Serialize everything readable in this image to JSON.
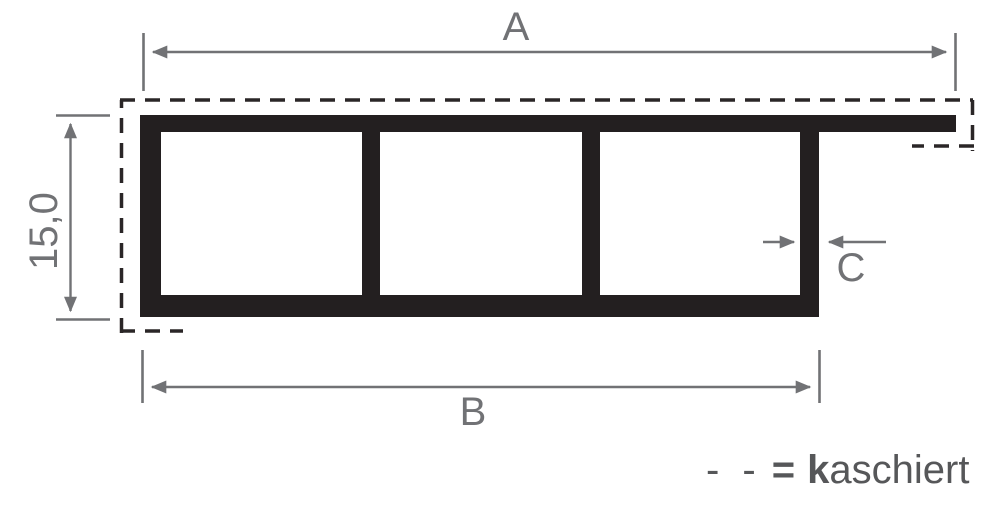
{
  "diagram": {
    "description": "Technical cross-section of a hollow chamber profile with three chambers and a lamination (kaschiert) dashed outline",
    "dimension_labels": {
      "top_width": "A",
      "left_height": "15,0",
      "bottom_width": "B",
      "wall_thickness": "C"
    },
    "legend": {
      "dash_symbol": "- -",
      "equals_sign": "=",
      "term_bold_prefix": "k",
      "term_rest": "aschiert"
    },
    "colors": {
      "profile_black": "#231f20",
      "dashed_outline": "#2a2627",
      "dimension_gray": "#717275",
      "legend_gray": "#565759",
      "background": "#ffffff"
    }
  }
}
